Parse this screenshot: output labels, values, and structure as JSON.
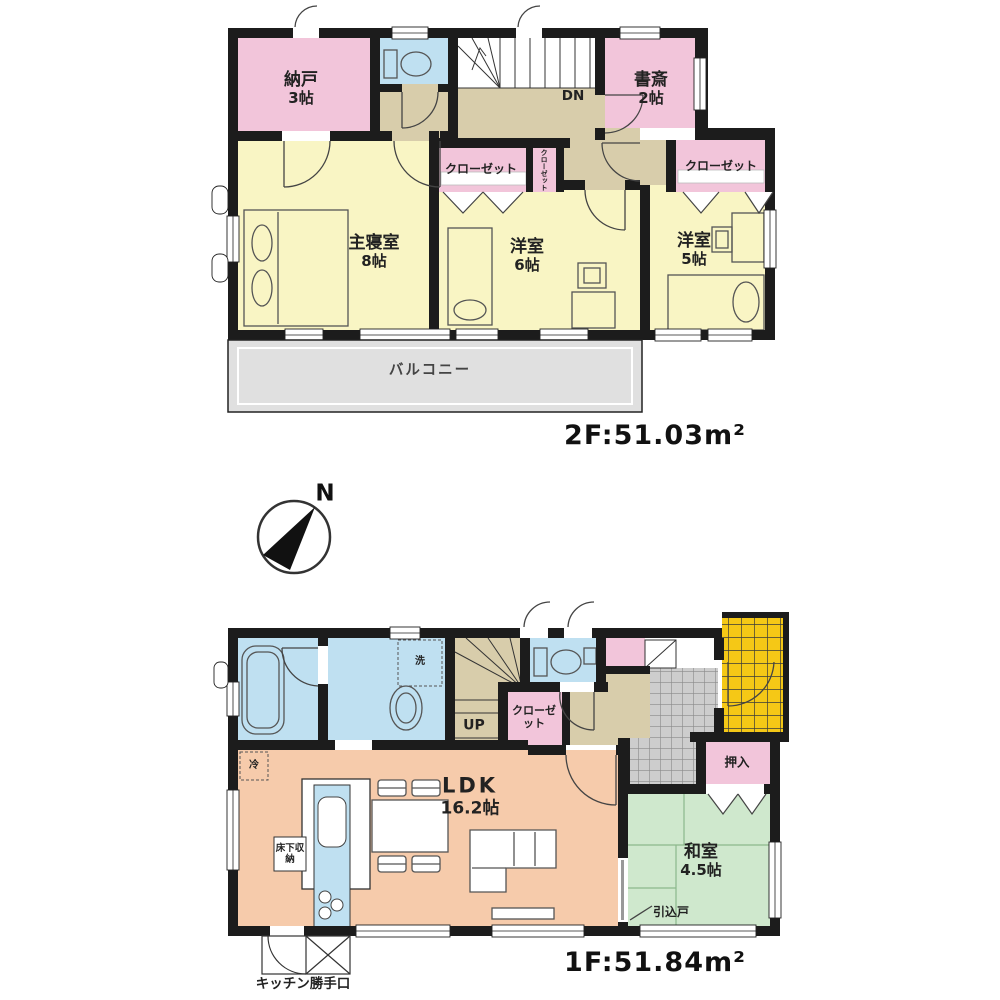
{
  "title": "間取り図",
  "compass": {
    "north_label": "N"
  },
  "floor2": {
    "area_label": "2F:51.03m²",
    "balcony_label": "バルコニー",
    "stairs_label": "DN",
    "rooms": {
      "nando": {
        "name": "納戸",
        "size": "3帖"
      },
      "shosai": {
        "name": "書斎",
        "size": "2帖"
      },
      "master": {
        "name": "主寝室",
        "size": "8帖"
      },
      "western6": {
        "name": "洋室",
        "size": "6帖"
      },
      "western5": {
        "name": "洋室",
        "size": "5帖"
      },
      "closet_center": "クローゼット",
      "closet_right": "クローゼット",
      "closet_small": "クローゼット"
    }
  },
  "floor1": {
    "area_label": "1F:51.84m²",
    "stairs_label": "UP",
    "rooms": {
      "ldk": {
        "name": "LDK",
        "size": "16.2帖"
      },
      "washitsu": {
        "name": "和室",
        "size": "4.5帖"
      },
      "oshiire": "押入",
      "closet": "クローゼット",
      "laundry": "洗",
      "fridge": "冷",
      "floor_storage": "床下収納",
      "sliding_door": "引込戸",
      "kitchen_back_door": "キッチン勝手口"
    }
  },
  "colors": {
    "wall": "#1c1c1c",
    "room_pink": "#f2c5da",
    "room_yellow": "#f9f5c4",
    "room_blue": "#bfe0f1",
    "room_tan": "#d8cdab",
    "room_salmon": "#f6cbab",
    "room_green": "#cfe8cd",
    "balcony_gray": "#e0e0e0",
    "tile_gray": "#cdcdcd",
    "porch_gold": "#f5c816"
  }
}
